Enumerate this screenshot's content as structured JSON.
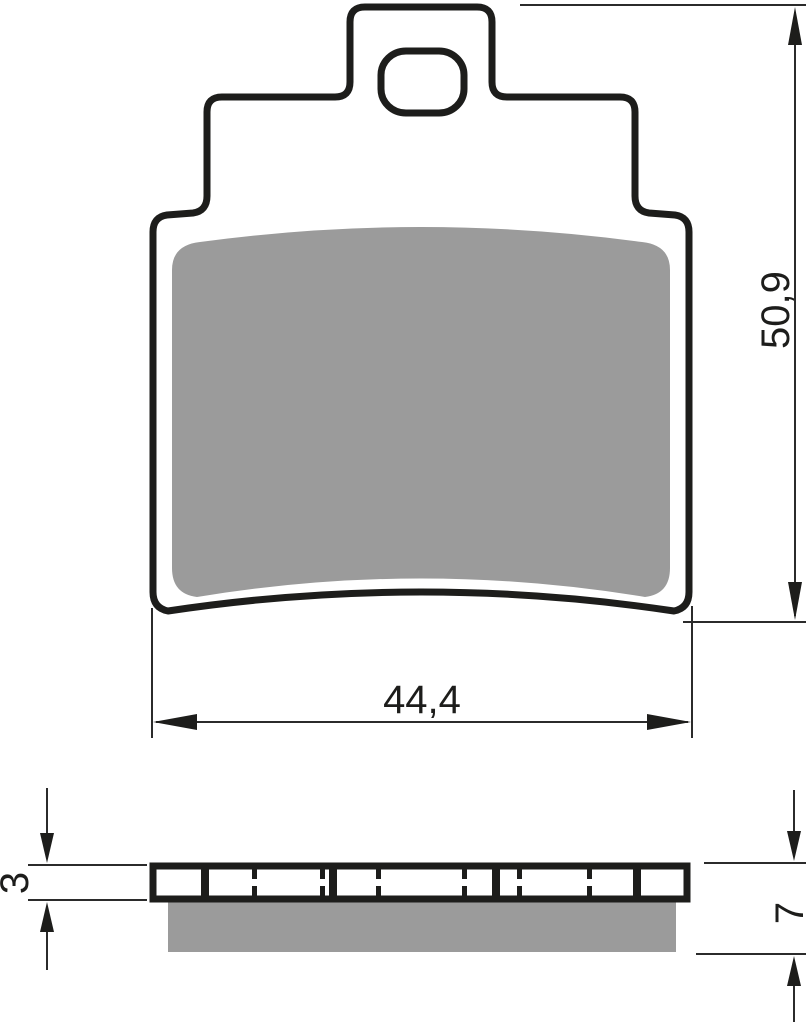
{
  "drawing": {
    "title": "Brake pad technical drawing",
    "views": {
      "front_view": "front profile with friction material",
      "side_view": "side profile with backplate and friction material"
    },
    "dimensions": {
      "pad_height": {
        "value": "50,9"
      },
      "pad_width": {
        "value": "44,4"
      },
      "backplate_thickness": {
        "value": "3"
      },
      "total_thickness": {
        "value": "7"
      }
    },
    "colors": {
      "outline": "#1d1d1b",
      "friction_material": "#9b9b9b",
      "dimension_lines": "#2b2b2b",
      "background": "#ffffff"
    }
  }
}
